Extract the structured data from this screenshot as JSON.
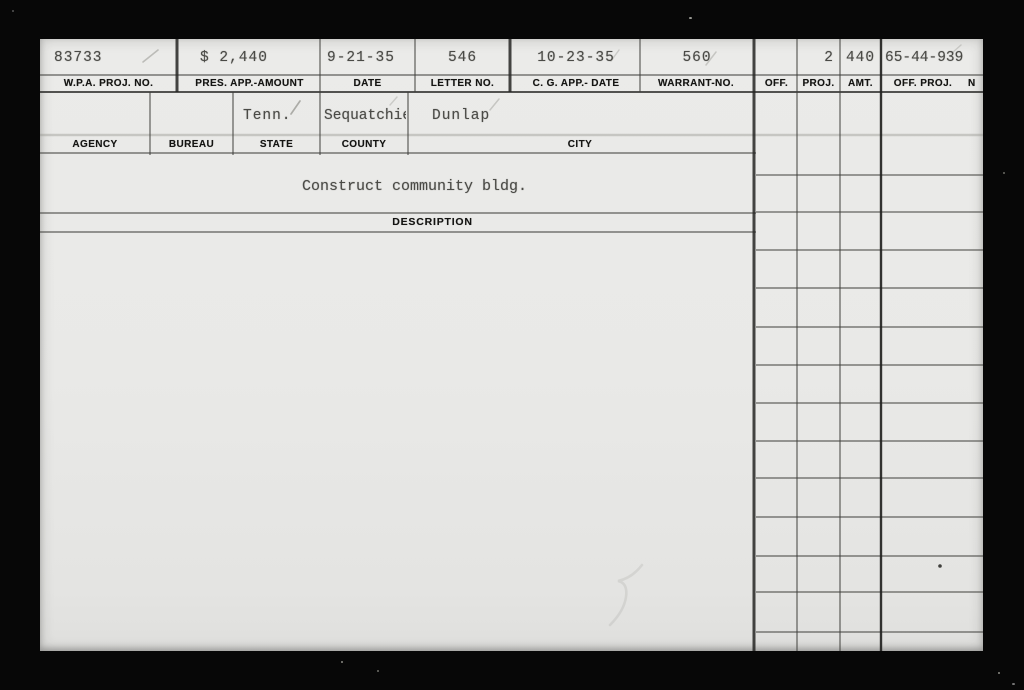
{
  "card": {
    "header_fields": [
      {
        "label": "W.P.A. PROJ. NO.",
        "value": "83733"
      },
      {
        "label": "PRES. APP.-AMOUNT",
        "value": "$ 2,440"
      },
      {
        "label": "DATE",
        "value": "9-21-35"
      },
      {
        "label": "LETTER NO.",
        "value": "546"
      },
      {
        "label": "C. G. APP.- DATE",
        "value": "10-23-35"
      },
      {
        "label": "WARRANT-NO.",
        "value": "560"
      }
    ],
    "office_fields": [
      {
        "label": "OFF.",
        "value": ""
      },
      {
        "label": "PROJ.",
        "value": "2"
      },
      {
        "label": "AMT.",
        "value": "440"
      },
      {
        "label": "OFF. PROJ.",
        "label_cut": "N",
        "value": "65-44-939"
      }
    ],
    "location_fields": [
      {
        "label": "AGENCY",
        "value": ""
      },
      {
        "label": "BUREAU",
        "value": ""
      },
      {
        "label": "STATE",
        "value": "Tenn."
      },
      {
        "label": "COUNTY",
        "value": "Sequatchie"
      },
      {
        "label": "CITY",
        "value": "Dunlap"
      }
    ],
    "description": {
      "label": "DESCRIPTION",
      "value": "Construct community bldg."
    }
  }
}
